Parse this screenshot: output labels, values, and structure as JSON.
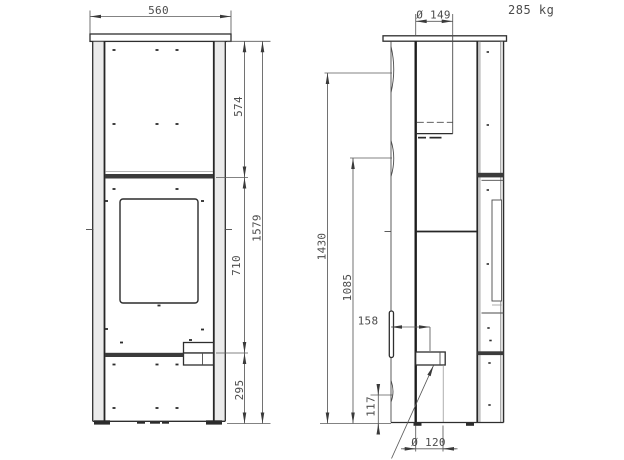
{
  "weight": {
    "label": "285 kg"
  },
  "front_view": {
    "dims": {
      "width": "560",
      "upper": "574",
      "total": "1579",
      "door": "710",
      "base": "295"
    }
  },
  "side_view": {
    "dims": {
      "top_flue_diameter": "Ø 149",
      "rear_flue_upper": "1430",
      "rear_flue_lower": "1085",
      "air_offset": "158",
      "air_height": "117",
      "air_diameter": "Ø 120"
    }
  },
  "colors": {
    "background": "#ffffff",
    "line_dark": "#1d1d1d",
    "line_medium": "#2e2e2e",
    "dimension_line": "#5a5a5a",
    "text": "#4c4c4c",
    "panel_shade": "#dadada"
  }
}
